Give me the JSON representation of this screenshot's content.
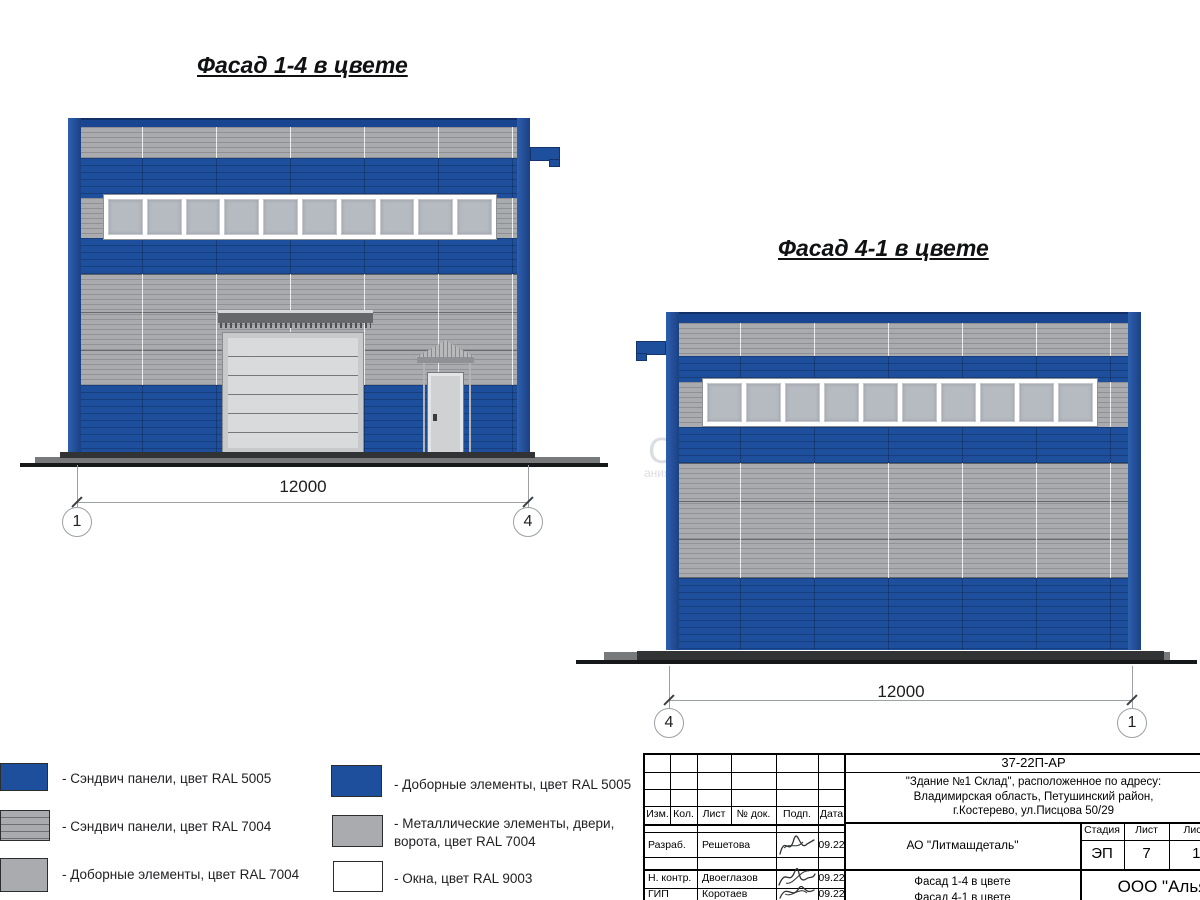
{
  "colors": {
    "ral5005": "#1e4f9c",
    "ral7004": "#a9abae",
    "ral9003": "#ffffff",
    "ground": "#17181a"
  },
  "left_drawing": {
    "title": "Фасад 1-4 в цвете",
    "dimension": "12000",
    "axis_left": "1",
    "axis_right": "4"
  },
  "right_drawing": {
    "title": "Фасад 4-1 в цвете",
    "dimension": "12000",
    "axis_left": "4",
    "axis_right": "1"
  },
  "legend": {
    "items": [
      {
        "label": "- Сэндвич панели, цвет RAL 5005",
        "color": "#1e4f9c"
      },
      {
        "label": "- Сэндвич панели, цвет RAL 7004",
        "color": "#a9abae"
      },
      {
        "label": "- Доборные элементы, цвет RAL 7004",
        "color": "#a9abae"
      },
      {
        "label": "- Доборные элементы, цвет RAL 5005",
        "color": "#1e4f9c"
      },
      {
        "label": "- Металлические элементы, двери, ворота, цвет RAL 7004",
        "color": "#a9abae"
      },
      {
        "label": "- Окна, цвет RAL 9003",
        "color": "#ffffff"
      }
    ]
  },
  "title_block": {
    "doc_code": "37-22П-АР",
    "address_line1": "\"Здание №1 Склад\", расположенное по адресу:",
    "address_line2": "Владимирская область, Петушинский район,",
    "address_line3": "г.Костерево, ул.Писцова 50/29",
    "rev_headers": [
      "Изм.",
      "Кол.",
      "Лист",
      "№ док.",
      "Подп.",
      "Дата"
    ],
    "signature_rows": [
      {
        "role": "Разраб.",
        "name": "Решетова",
        "date": "09.22"
      },
      {
        "role": "Н. контр.",
        "name": "Двоеглазов",
        "date": "09.22"
      },
      {
        "role": "ГИП",
        "name": "Коротаев",
        "date": "09.22"
      }
    ],
    "organization": "АО \"Литмашдеталь\"",
    "stage_label": "Стадия",
    "stage_value": "ЭП",
    "sheet_label": "Лист",
    "sheet_value": "7",
    "sheets_label": "Листов",
    "sheets_value": "14",
    "sheet_title_line1": "Фасад 1-4 в цвете",
    "sheet_title_line2": "Фасад 4-1 в цвете",
    "company": "ООО \"Альянс\""
  },
  "watermark": {
    "big": "С",
    "small": "ания"
  }
}
